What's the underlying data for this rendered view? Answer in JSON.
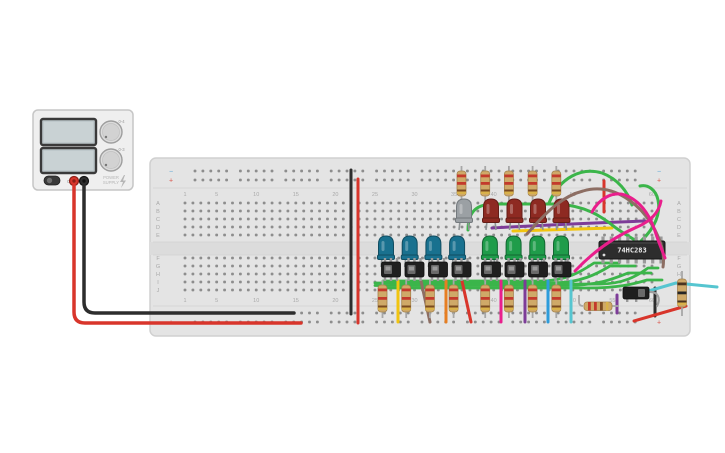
{
  "scene": {
    "width": 725,
    "height": 453,
    "background": "#ffffff"
  },
  "power_supply": {
    "name": "power-supply",
    "body": {
      "x": 33,
      "y": 110,
      "w": 100,
      "h": 80,
      "fill": "#efefef",
      "stroke": "#c6c6c6"
    },
    "displays": [
      {
        "x": 41,
        "y": 119,
        "w": 55,
        "h": 26,
        "screen": "#c9d2d4",
        "frame": "#3a3a3a",
        "value": ""
      },
      {
        "x": 41,
        "y": 148,
        "w": 55,
        "h": 25,
        "screen": "#c9d2d4",
        "frame": "#3a3a3a",
        "value": ""
      }
    ],
    "knobs": [
      {
        "cx": 111,
        "cy": 132,
        "r": 11,
        "label": "0-4"
      },
      {
        "cx": 111,
        "cy": 160,
        "r": 11,
        "label": "0-3"
      }
    ],
    "power_button": {
      "x": 44,
      "y": 176,
      "w": 16,
      "h": 9,
      "label": "OFF"
    },
    "brand": {
      "line1": "POWER",
      "line2": "SUPPLY",
      "icon": "bolt-icon",
      "x": 103,
      "y": 178
    },
    "terminals": [
      {
        "name": "positive-terminal",
        "cx": 74,
        "cy": 181,
        "fill": "#d8352b",
        "ring": "#8e1f16"
      },
      {
        "name": "negative-terminal",
        "cx": 84,
        "cy": 181,
        "fill": "#2e2e2e",
        "ring": "#111111"
      }
    ]
  },
  "breadboard": {
    "x": 150,
    "y": 158,
    "w": 540,
    "h": 178,
    "fill": "#e4e4e4",
    "stroke": "#d0d0d0",
    "hole": "#8d8d8d",
    "channel": "#dcdcdc",
    "col1_x": 185,
    "col_spacing": 7.915,
    "num_cols": 60,
    "rows_upper_y": [
      203,
      211,
      219,
      227,
      235
    ],
    "rows_lower_y": [
      258,
      266,
      274,
      282,
      290
    ],
    "rails_top_y": [
      171,
      180
    ],
    "rails_bottom_y": [
      313,
      322
    ],
    "rail_start_x": 195,
    "rail_groups": 10,
    "rail_group_pitch": 45.4,
    "rail_hole_pitch": 7.9,
    "row_labels_upper": [
      "A",
      "B",
      "C",
      "D",
      "E"
    ],
    "row_labels_lower": [
      "F",
      "G",
      "H",
      "I",
      "J"
    ],
    "row_label_left_x": 158,
    "row_label_right_x": 679,
    "column_labels": [
      1,
      5,
      10,
      15,
      20,
      25,
      30,
      35,
      40,
      45,
      50,
      55,
      60
    ],
    "col_label_top_y": 196,
    "col_label_bottom_y": 302,
    "label_color": "#a9a9a9",
    "minus_symbol": "−",
    "plus_symbol": "+",
    "minus_color": "#5aa7d6",
    "plus_color": "#d9534a",
    "marker_left_x": 171,
    "marker_right_x": 659
  },
  "ic": {
    "x": 599,
    "y": 241,
    "w": 66,
    "h": 18,
    "label": "74HC283",
    "body": "#2d2d2d",
    "text_color": "#ececec",
    "pins": 8,
    "pin_color": "#9a9a9a"
  },
  "leds": [
    {
      "name": "led-gray",
      "cx": 464,
      "top": 199,
      "fill": "#9ba0a4",
      "stroke": "#73797d"
    },
    {
      "name": "led-red",
      "cx": 491,
      "top": 199,
      "fill": "#8e2a22",
      "stroke": "#641d17"
    },
    {
      "name": "led-red",
      "cx": 514.5,
      "top": 199,
      "fill": "#8e2a22",
      "stroke": "#641d17"
    },
    {
      "name": "led-red",
      "cx": 538,
      "top": 199,
      "fill": "#8e2a22",
      "stroke": "#641d17"
    },
    {
      "name": "led-red",
      "cx": 561.5,
      "top": 199,
      "fill": "#8e2a22",
      "stroke": "#641d17"
    },
    {
      "name": "led-blue",
      "cx": 386,
      "top": 236,
      "fill": "#19718f",
      "stroke": "#114d61"
    },
    {
      "name": "led-blue",
      "cx": 409.7,
      "top": 236,
      "fill": "#19718f",
      "stroke": "#114d61"
    },
    {
      "name": "led-blue",
      "cx": 433.4,
      "top": 236,
      "fill": "#19718f",
      "stroke": "#114d61"
    },
    {
      "name": "led-blue",
      "cx": 457.1,
      "top": 236,
      "fill": "#19718f",
      "stroke": "#114d61"
    },
    {
      "name": "led-green",
      "cx": 489.9,
      "top": 236,
      "fill": "#1f9c4a",
      "stroke": "#146632"
    },
    {
      "name": "led-green",
      "cx": 513.6,
      "top": 236,
      "fill": "#1f9c4a",
      "stroke": "#146632"
    },
    {
      "name": "led-green",
      "cx": 537.3,
      "top": 236,
      "fill": "#1f9c4a",
      "stroke": "#146632"
    },
    {
      "name": "led-green",
      "cx": 561,
      "top": 236,
      "fill": "#1f9c4a",
      "stroke": "#146632"
    }
  ],
  "resistors": {
    "body_fill": "#cfa968",
    "body_stroke": "#a3824c",
    "lead": "#a7a7a7",
    "bands_std": [
      "#c33a2c",
      "#c33a2c",
      "#7a4a21",
      "#d9b24a"
    ],
    "bands_dark": [
      "#4a3420",
      "#262626",
      "#4a3420",
      "#d9b24a"
    ],
    "vertical": [
      {
        "x": 461.5,
        "leadY1": 166,
        "leadY2": 201,
        "bodyY": 171,
        "bodyH": 25,
        "bands": "std"
      },
      {
        "x": 485.2,
        "leadY1": 166,
        "leadY2": 201,
        "bodyY": 171,
        "bodyH": 25,
        "bands": "std"
      },
      {
        "x": 508.9,
        "leadY1": 166,
        "leadY2": 201,
        "bodyY": 171,
        "bodyH": 25,
        "bands": "std"
      },
      {
        "x": 532.6,
        "leadY1": 166,
        "leadY2": 201,
        "bodyY": 171,
        "bodyH": 25,
        "bands": "std"
      },
      {
        "x": 556.3,
        "leadY1": 166,
        "leadY2": 201,
        "bodyY": 171,
        "bodyH": 25,
        "bands": "std"
      },
      {
        "x": 382.5,
        "leadY1": 280,
        "leadY2": 318,
        "bodyY": 285,
        "bodyH": 27,
        "bands": "std"
      },
      {
        "x": 406.2,
        "leadY1": 280,
        "leadY2": 318,
        "bodyY": 285,
        "bodyH": 27,
        "bands": "std"
      },
      {
        "x": 429.9,
        "leadY1": 280,
        "leadY2": 318,
        "bodyY": 285,
        "bodyH": 27,
        "bands": "std"
      },
      {
        "x": 453.6,
        "leadY1": 280,
        "leadY2": 318,
        "bodyY": 285,
        "bodyH": 27,
        "bands": "std"
      },
      {
        "x": 485.2,
        "leadY1": 280,
        "leadY2": 318,
        "bodyY": 285,
        "bodyH": 27,
        "bands": "std"
      },
      {
        "x": 508.9,
        "leadY1": 280,
        "leadY2": 318,
        "bodyY": 285,
        "bodyH": 27,
        "bands": "std"
      },
      {
        "x": 532.6,
        "leadY1": 280,
        "leadY2": 318,
        "bodyY": 285,
        "bodyH": 27,
        "bands": "std"
      },
      {
        "x": 556.3,
        "leadY1": 280,
        "leadY2": 318,
        "bodyY": 285,
        "bodyH": 27,
        "bands": "std"
      },
      {
        "x": 682,
        "leadY1": 271,
        "leadY2": 316,
        "bodyY": 279,
        "bodyH": 28,
        "bands": "dark"
      }
    ],
    "horizontal": {
      "bodyX": 584,
      "bodyY": 302,
      "bodyW": 28,
      "bodyH": 8.5,
      "leadLeft": "M579,295 L579,302 Q579,306 583,306",
      "leadRight": "M612,306 L619,306",
      "bands": "std"
    }
  },
  "switches": {
    "body": "#1f1f1f",
    "slider": "#6a6a6a",
    "slider_inner": "#9a9a9a",
    "pin": "#9a9a9a",
    "y": 262,
    "w": 19,
    "h": 15,
    "xs": [
      391,
      414.5,
      438,
      461.5,
      491,
      514.5,
      538,
      561.5
    ]
  },
  "push_switch": {
    "x": 623,
    "y": 287,
    "w": 26,
    "h": 12,
    "body": "#1f1f1f",
    "slider": "#6a6a6a",
    "lead": "M648,292 C658,291 661,298 657,306",
    "lead_color": "#9e9e9e"
  },
  "wires": [
    {
      "name": "psu-negative-wire",
      "color": "#2d2d2d",
      "width": 3.5,
      "layer": "under",
      "path": "M84,185 L84,302 Q84,313 95,313 L294,313"
    },
    {
      "name": "psu-positive-wire",
      "color": "#d8352b",
      "width": 3.5,
      "layer": "under",
      "path": "M74,185 L74,312 Q74,323 85,323 L301,323"
    },
    {
      "name": "rail-jumper-negative",
      "color": "#2d2d2d",
      "width": 3,
      "layer": "under",
      "path": "M351,170 L351,314"
    },
    {
      "name": "rail-jumper-positive",
      "color": "#d8352b",
      "width": 3,
      "layer": "under",
      "path": "M358,179 L358,323"
    },
    {
      "name": "wire-red-short-top",
      "color": "#d8352b",
      "width": 3,
      "layer": "under",
      "path": "M604,181 L604,212"
    },
    {
      "name": "wire-purple-top",
      "color": "#7d3c98",
      "width": 3,
      "layer": "under",
      "path": "M492,228 C510,227 560,224 645,221"
    },
    {
      "name": "wire-yellow-top",
      "color": "#f1c40f",
      "width": 3,
      "layer": "under",
      "path": "M513,231 L612,228"
    },
    {
      "name": "wire-green-arc",
      "color": "#3bb54a",
      "width": 3,
      "layer": "under",
      "path": "M549,203 C560,177 582,167 602,173 C618,179 628,192 632,205"
    },
    {
      "name": "wire-green-hook",
      "color": "#3bb54a",
      "width": 3,
      "layer": "under",
      "path": "M641,241 C655,228 661,213 658,200 C656,190 648,184 640,186"
    },
    {
      "name": "wire-green-main",
      "color": "#3bb54a",
      "width": 3,
      "layer": "under",
      "path": "M468,230 C468,210 478,204 495,204 L558,204 C585,206 600,215 616,228 C626,235 633,239 640,243"
    },
    {
      "name": "wire-green-bus-1",
      "color": "#3bb54a",
      "width": 2.8,
      "layer": "under",
      "path": "M375,283 L552,283 C580,283 597,274 610,266 L635,266"
    },
    {
      "name": "wire-green-bus-2",
      "color": "#3bb54a",
      "width": 2.8,
      "layer": "under",
      "path": "M375,285.5 L566,285.5 C597,285.5 613,279 628,273 L651,273"
    },
    {
      "name": "wire-green-bus-3",
      "color": "#3bb54a",
      "width": 2.8,
      "layer": "under",
      "path": "M383,281 L540,281 C567,281 582,271 594,263 L619,263"
    },
    {
      "name": "wire-green-bus-4",
      "color": "#3bb54a",
      "width": 2.8,
      "layer": "under",
      "path": "M383,288 L588,288 C618,288 634,284 647,280 L662,280"
    },
    {
      "name": "wire-green-bus-5",
      "color": "#3bb54a",
      "width": 2.8,
      "layer": "under",
      "path": "M391,285 L600,284 C623,284 637,276 648,268 L658,268"
    },
    {
      "name": "wire-yellow-v",
      "color": "#f1c40f",
      "width": 3,
      "layer": "under",
      "path": "M398,281 L398,322"
    },
    {
      "name": "wire-brown-diag",
      "color": "#8d6e63",
      "width": 3,
      "layer": "under",
      "path": "M421,281 L430,322"
    },
    {
      "name": "wire-orange-v",
      "color": "#e67e22",
      "width": 3,
      "layer": "under",
      "path": "M446,281 L446,322"
    },
    {
      "name": "wire-red-diag",
      "color": "#d8352b",
      "width": 3,
      "layer": "under",
      "path": "M462,281 L471,322"
    },
    {
      "name": "wire-magenta-v",
      "color": "#e91e8c",
      "width": 3,
      "layer": "under",
      "path": "M501,281 L501,322"
    },
    {
      "name": "wire-purple-v",
      "color": "#7d3c98",
      "width": 3,
      "layer": "under",
      "path": "M525,281 L525,322"
    },
    {
      "name": "wire-blue-v",
      "color": "#2d9cdb",
      "width": 3,
      "layer": "under",
      "path": "M548,281 L548,322"
    },
    {
      "name": "wire-cyan-v",
      "color": "#56c5d0",
      "width": 3,
      "layer": "under",
      "path": "M571,281 L571,322"
    },
    {
      "name": "wire-purple-short-br",
      "color": "#7d3c98",
      "width": 3,
      "layer": "under",
      "path": "M617,295 L617,313"
    },
    {
      "name": "wire-black-short-br",
      "color": "#2d2d2d",
      "width": 3,
      "layer": "under",
      "path": "M655,288 L655,316"
    },
    {
      "name": "wire-red-diag-br",
      "color": "#d8352b",
      "width": 3,
      "layer": "under",
      "path": "M634,321 L686,306"
    },
    {
      "name": "wire-cyan-long-br",
      "color": "#56c5d0",
      "width": 3,
      "layer": "under",
      "path": "M628,297 L676,283 L717,287"
    },
    {
      "name": "wire-brown-curve",
      "color": "#8d6e63",
      "width": 3,
      "layer": "over",
      "path": "M527,234 C548,210 563,196 583,191 C613,182 641,204 655,230 C661,242 665,254 663,267"
    },
    {
      "name": "wire-magenta-1",
      "color": "#e91e8c",
      "width": 3,
      "layer": "over",
      "path": "M575,271 C595,250 616,236 637,227 C651,221 659,212 661,201"
    },
    {
      "name": "wire-magenta-2",
      "color": "#e91e8c",
      "width": 3,
      "layer": "over",
      "path": "M592,212 C599,199 612,191 625,195 C641,201 650,216 655,231 C658,241 662,250 665,258"
    }
  ]
}
